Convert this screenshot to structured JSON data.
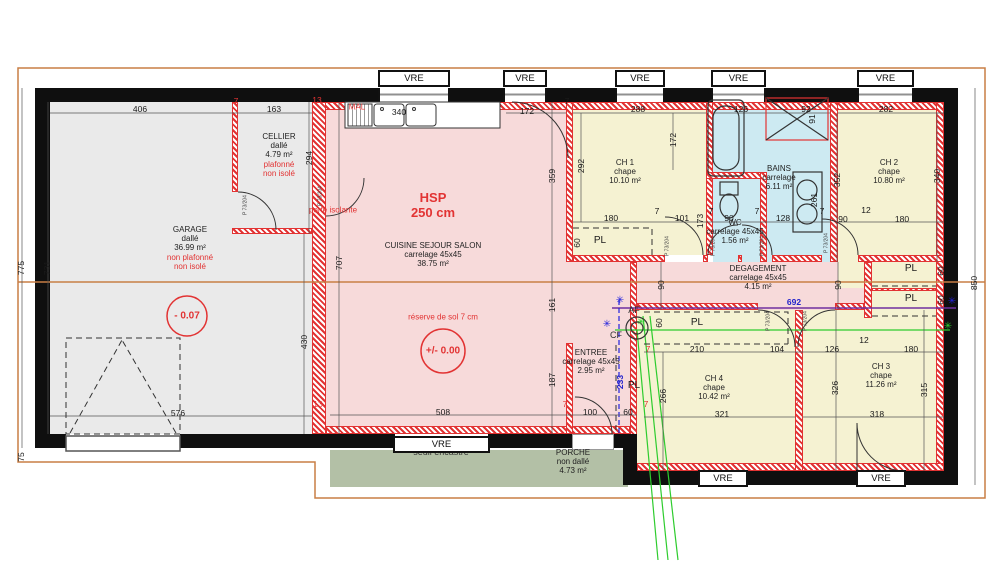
{
  "plan_title": "floor-plan",
  "colors": {
    "wall": "#0f0f0f",
    "hatch_red": "#e23333",
    "floor_pink": "#f7dada",
    "floor_yellow": "#f5f2d2",
    "floor_blue": "#cdeaf2",
    "floor_gray": "#eaeaea",
    "porch_green": "#b3c0a6",
    "boundary_orange": "#c87f45",
    "line_blue": "#2222cc",
    "line_green": "#2ecc2e",
    "line_purple": "#7030a0"
  },
  "vre_label": "VRE",
  "pl_label": "PL",
  "door_label": "P 73/204",
  "rooms": [
    {
      "id": "garage",
      "title": "GARAGE",
      "subs": [
        "dallé",
        "36.99 m²"
      ],
      "reds": [
        "non plafonné",
        "non isolé"
      ],
      "x": 190,
      "y": 248
    },
    {
      "id": "cellier",
      "title": "CELLIER",
      "subs": [
        "dallé",
        "4.79 m²"
      ],
      "reds": [
        "plafonné",
        "non isolé"
      ],
      "x": 279,
      "y": 155
    },
    {
      "id": "cuisine",
      "title": "CUISINE SEJOUR SALON",
      "subs": [
        "carrelage 45x45",
        "38.75 m²"
      ],
      "reds": [],
      "x": 433,
      "y": 255
    },
    {
      "id": "entree",
      "title": "ENTREE",
      "subs": [
        "carrelage 45x45",
        "2.95 m²"
      ],
      "reds": [],
      "x": 591,
      "y": 362
    },
    {
      "id": "ch1",
      "title": "CH 1",
      "subs": [
        "chape",
        "10.10 m²"
      ],
      "reds": [],
      "x": 625,
      "y": 172
    },
    {
      "id": "ch2",
      "title": "CH 2",
      "subs": [
        "chape",
        "10.80 m²"
      ],
      "reds": [],
      "x": 889,
      "y": 172
    },
    {
      "id": "ch3",
      "title": "CH 3",
      "subs": [
        "chape",
        "11.26 m²"
      ],
      "reds": [],
      "x": 881,
      "y": 376
    },
    {
      "id": "ch4",
      "title": "CH 4",
      "subs": [
        "chape",
        "10.42 m²"
      ],
      "reds": [],
      "x": 714,
      "y": 388
    },
    {
      "id": "bains",
      "title": "BAINS",
      "subs": [
        "carrelage",
        "6.11 m²"
      ],
      "reds": [],
      "x": 779,
      "y": 178
    },
    {
      "id": "wc",
      "title": "WC",
      "subs": [
        "carrelage 45x45",
        "1.56 m²"
      ],
      "reds": [],
      "x": 735,
      "y": 232
    },
    {
      "id": "degagement",
      "title": "DEGAGEMENT",
      "subs": [
        "carrelage 45x45",
        "4.15 m²"
      ],
      "reds": [],
      "x": 758,
      "y": 278
    },
    {
      "id": "porche",
      "title": "PORCHE",
      "subs": [
        "non dallé",
        "4.73 m²"
      ],
      "reds": [],
      "x": 573,
      "y": 462
    }
  ],
  "annotations": [
    {
      "id": "hsp",
      "t": "HSP",
      "x": 433,
      "y": 198,
      "cls": "red lg"
    },
    {
      "id": "hsp-value",
      "t": "250 cm",
      "x": 433,
      "y": 213,
      "cls": "red lg"
    },
    {
      "id": "reserve-sol",
      "t": "réserve de sol 7 cm",
      "x": 443,
      "y": 318,
      "cls": "red sm"
    },
    {
      "id": "level-garage",
      "t": "- 0.07",
      "x": 187,
      "y": 316,
      "cls": "lvl"
    },
    {
      "id": "level-sejour",
      "t": "+/- 0.00",
      "x": 443,
      "y": 351,
      "cls": "lvl"
    },
    {
      "id": "porte-isolante",
      "t": "porte isolante",
      "x": 333,
      "y": 211,
      "cls": "red sm"
    },
    {
      "id": "machine-a-laver",
      "t": "MAL",
      "x": 357,
      "y": 108,
      "cls": "red sm"
    },
    {
      "id": "seuil-encastre",
      "t": "seuil encastré",
      "x": 441,
      "y": 453,
      "cls": "md"
    },
    {
      "id": "af",
      "t": "AF",
      "x": 634,
      "y": 311,
      "cls": "md"
    },
    {
      "id": "cf",
      "t": "CF",
      "x": 616,
      "y": 336,
      "cls": "md"
    }
  ],
  "dims": [
    {
      "t": "406",
      "x": 140,
      "y": 109
    },
    {
      "t": "163",
      "x": 274,
      "y": 109
    },
    {
      "t": "7",
      "x": 236,
      "y": 101,
      "c": "red"
    },
    {
      "t": "13",
      "x": 317,
      "y": 100,
      "c": "red"
    },
    {
      "t": "340",
      "x": 399,
      "y": 112
    },
    {
      "t": "172",
      "x": 527,
      "y": 111
    },
    {
      "t": "7",
      "x": 567,
      "y": 101
    },
    {
      "t": "288",
      "x": 638,
      "y": 109
    },
    {
      "t": "126",
      "x": 741,
      "y": 109
    },
    {
      "t": "92",
      "x": 806,
      "y": 109
    },
    {
      "t": "91",
      "x": 812,
      "y": 119,
      "v": 1
    },
    {
      "t": "282",
      "x": 886,
      "y": 109
    },
    {
      "t": "775",
      "x": 21,
      "y": 268,
      "v": 1
    },
    {
      "t": "731",
      "x": 47,
      "y": 268,
      "v": 1
    },
    {
      "t": "294",
      "x": 309,
      "y": 158,
      "v": 1
    },
    {
      "t": "707",
      "x": 339,
      "y": 263,
      "v": 1
    },
    {
      "t": "430",
      "x": 304,
      "y": 342,
      "v": 1
    },
    {
      "t": "75",
      "x": 21,
      "y": 457,
      "v": 1
    },
    {
      "t": "359",
      "x": 552,
      "y": 176,
      "v": 1
    },
    {
      "t": "161",
      "x": 552,
      "y": 305,
      "v": 1
    },
    {
      "t": "187",
      "x": 552,
      "y": 380,
      "v": 1
    },
    {
      "t": "292",
      "x": 581,
      "y": 166,
      "v": 1
    },
    {
      "t": "172",
      "x": 673,
      "y": 140,
      "v": 1
    },
    {
      "t": "180",
      "x": 611,
      "y": 218
    },
    {
      "t": "7",
      "x": 657,
      "y": 211
    },
    {
      "t": "101",
      "x": 682,
      "y": 218
    },
    {
      "t": "173",
      "x": 700,
      "y": 221,
      "v": 1
    },
    {
      "t": "90",
      "x": 729,
      "y": 218
    },
    {
      "t": "7",
      "x": 711,
      "y": 211
    },
    {
      "t": "7",
      "x": 757,
      "y": 211
    },
    {
      "t": "128",
      "x": 783,
      "y": 218
    },
    {
      "t": "261",
      "x": 814,
      "y": 200,
      "v": 1
    },
    {
      "t": "60",
      "x": 577,
      "y": 243,
      "v": 1
    },
    {
      "t": "352",
      "x": 837,
      "y": 180,
      "v": 1
    },
    {
      "t": "340",
      "x": 937,
      "y": 176,
      "v": 1
    },
    {
      "t": "90",
      "x": 843,
      "y": 219
    },
    {
      "t": "12",
      "x": 866,
      "y": 210
    },
    {
      "t": "180",
      "x": 902,
      "y": 219
    },
    {
      "t": "7",
      "x": 822,
      "y": 211
    },
    {
      "t": "60",
      "x": 941,
      "y": 271,
      "v": 1
    },
    {
      "t": "60",
      "x": 941,
      "y": 300,
      "v": 1
    },
    {
      "t": "850",
      "x": 974,
      "y": 283,
      "v": 1
    },
    {
      "t": "90",
      "x": 661,
      "y": 285,
      "v": 1
    },
    {
      "t": "90",
      "x": 838,
      "y": 285,
      "v": 1
    },
    {
      "t": "692",
      "x": 794,
      "y": 302,
      "c": "blue"
    },
    {
      "t": "60",
      "x": 659,
      "y": 323,
      "v": 1
    },
    {
      "t": "210",
      "x": 697,
      "y": 349
    },
    {
      "t": "104",
      "x": 777,
      "y": 349
    },
    {
      "t": "7",
      "x": 648,
      "y": 349,
      "c": "red"
    },
    {
      "t": "126",
      "x": 832,
      "y": 349
    },
    {
      "t": "12",
      "x": 864,
      "y": 340
    },
    {
      "t": "180",
      "x": 911,
      "y": 349
    },
    {
      "t": "266",
      "x": 663,
      "y": 396,
      "v": 1
    },
    {
      "t": "326",
      "x": 835,
      "y": 388,
      "v": 1
    },
    {
      "t": "315",
      "x": 924,
      "y": 390,
      "v": 1
    },
    {
      "t": "321",
      "x": 722,
      "y": 414
    },
    {
      "t": "318",
      "x": 877,
      "y": 414
    },
    {
      "t": "7",
      "x": 797,
      "y": 403,
      "c": "red"
    },
    {
      "t": "576",
      "x": 178,
      "y": 413
    },
    {
      "t": "13",
      "x": 318,
      "y": 404,
      "c": "red"
    },
    {
      "t": "508",
      "x": 443,
      "y": 412
    },
    {
      "t": "7",
      "x": 565,
      "y": 404,
      "c": "red"
    },
    {
      "t": "100",
      "x": 590,
      "y": 412
    },
    {
      "t": "60",
      "x": 628,
      "y": 412
    },
    {
      "t": "7",
      "x": 646,
      "y": 404,
      "c": "red"
    },
    {
      "t": "233",
      "x": 620,
      "y": 382,
      "v": 1,
      "c": "blue"
    }
  ],
  "stars": [
    {
      "x": 620,
      "y": 301,
      "c": "blue"
    },
    {
      "x": 607,
      "y": 325,
      "c": "blue"
    },
    {
      "x": 952,
      "y": 302,
      "c": "blue"
    },
    {
      "x": 948,
      "y": 327,
      "c": "green"
    },
    {
      "x": 641,
      "y": 323,
      "c": "green"
    }
  ],
  "vre_windows": [
    {
      "x": 378,
      "y": 70,
      "w": 72
    },
    {
      "x": 503,
      "y": 70,
      "w": 44
    },
    {
      "x": 615,
      "y": 70,
      "w": 50
    },
    {
      "x": 711,
      "y": 70,
      "w": 55
    },
    {
      "x": 857,
      "y": 70,
      "w": 57
    },
    {
      "x": 393,
      "y": 436,
      "w": 97
    },
    {
      "x": 698,
      "y": 470,
      "w": 50
    },
    {
      "x": 856,
      "y": 470,
      "w": 50
    }
  ],
  "pl_positions": [
    {
      "x": 600,
      "y": 241
    },
    {
      "x": 911,
      "y": 269
    },
    {
      "x": 911,
      "y": 299
    },
    {
      "x": 697,
      "y": 323
    },
    {
      "x": 634,
      "y": 386
    }
  ],
  "door_labels": [
    {
      "x": 246,
      "y": 205
    },
    {
      "x": 321,
      "y": 196
    },
    {
      "x": 668,
      "y": 246
    },
    {
      "x": 714,
      "y": 246
    },
    {
      "x": 763,
      "y": 246
    },
    {
      "x": 827,
      "y": 243
    },
    {
      "x": 769,
      "y": 321
    },
    {
      "x": 806,
      "y": 321
    }
  ]
}
